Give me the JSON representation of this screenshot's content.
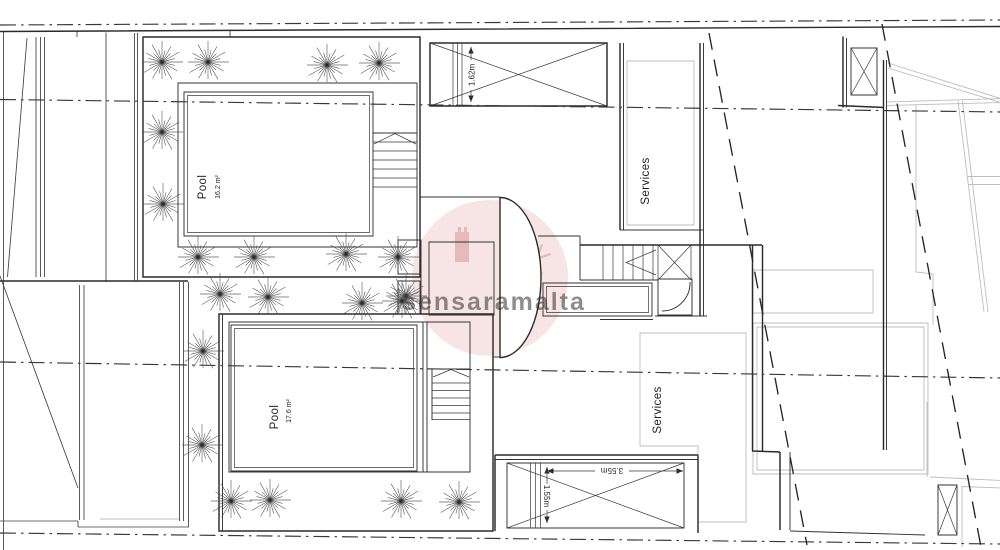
{
  "drawing": {
    "labels": {
      "pool_upper": {
        "name": "Pool",
        "area": "16.2 m²"
      },
      "pool_lower": {
        "name": "Pool",
        "area": "17.6 m²"
      },
      "services_upper": "Services",
      "services_lower": "Services"
    },
    "dimensions": {
      "shaft_height": "1.62m",
      "terrace_width": "3.55m",
      "terrace_depth": "1.55m"
    },
    "watermark": {
      "text": "sensaramalta"
    }
  },
  "colors": {
    "line": "#2b2b2b",
    "line_light": "#3a3a3a",
    "neighbor_gray": "#bdbdbd",
    "watermark_pink": "#d98a8f",
    "background": "#ffffff"
  }
}
